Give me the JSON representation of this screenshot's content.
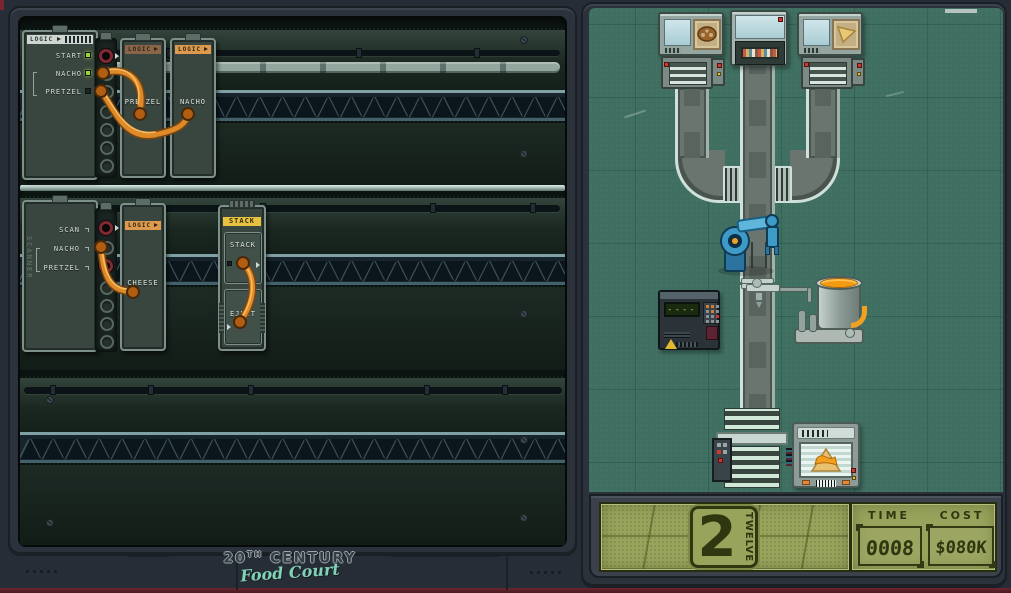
{
  "app": {
    "name": "20th Century Food Court"
  },
  "left_panel": {
    "logic_board": {
      "header": "LOGIC",
      "rows": [
        {
          "label": "START",
          "led": "on"
        },
        {
          "label": "NACHO",
          "led": "on"
        },
        {
          "label": "PRETZEL",
          "led": "off"
        }
      ]
    },
    "scanner_board": {
      "side_label": "SCANNER",
      "rows": [
        {
          "label": "SCAN"
        },
        {
          "label": "NACHO"
        },
        {
          "label": "PRETZEL"
        }
      ]
    },
    "modules": {
      "pretzel": {
        "header": "LOGIC",
        "name": "PRETZEL"
      },
      "nacho": {
        "header": "LOGIC",
        "name": "NACHO"
      },
      "cheese": {
        "header": "LOGIC",
        "name": "CHEESE"
      },
      "stack": {
        "header": "STACK",
        "port_stack": "STACK",
        "port_eject": "EJECT"
      }
    }
  },
  "logo": {
    "line1_prefix": "20",
    "line1_sup": "TH",
    "line1_rest": "CENTURY",
    "line2": "Food Court"
  },
  "playfield": {
    "scanner_screen_text": "------",
    "icons": {
      "left_machine": "pretzel-icon",
      "center_machine": "chip-hopper",
      "right_machine": "tortilla-chip-icon",
      "goal_display": "nacho-with-cheese-icon"
    }
  },
  "scoreboard": {
    "level_number": "2",
    "level_word": "TWELVE",
    "time": {
      "label": "TIME",
      "value": "0008",
      "ghost": "8888"
    },
    "cost": {
      "label": "COST",
      "value": "$080K",
      "ghost": "$888K"
    }
  },
  "decor": {
    "truss": "▲▼▲▼▲▼▲▼▲▼▲▼▲▼▲▼▲▼▲▼▲▼▲▼▲▼▲▼▲▼▲▼▲▼▲▼▲▼▲▼▲▼▲▼▲▼▲▼▲▼▲▼▲▼▲▼▲▼▲▼"
  },
  "colors": {
    "wire": "#e08a28",
    "lcd_bg": "#98a35c",
    "lcd_ink": "#2e370f",
    "playfield": "#3f6f61",
    "cheese": "#f29b12",
    "robot_arm": "#3e9ac6"
  }
}
